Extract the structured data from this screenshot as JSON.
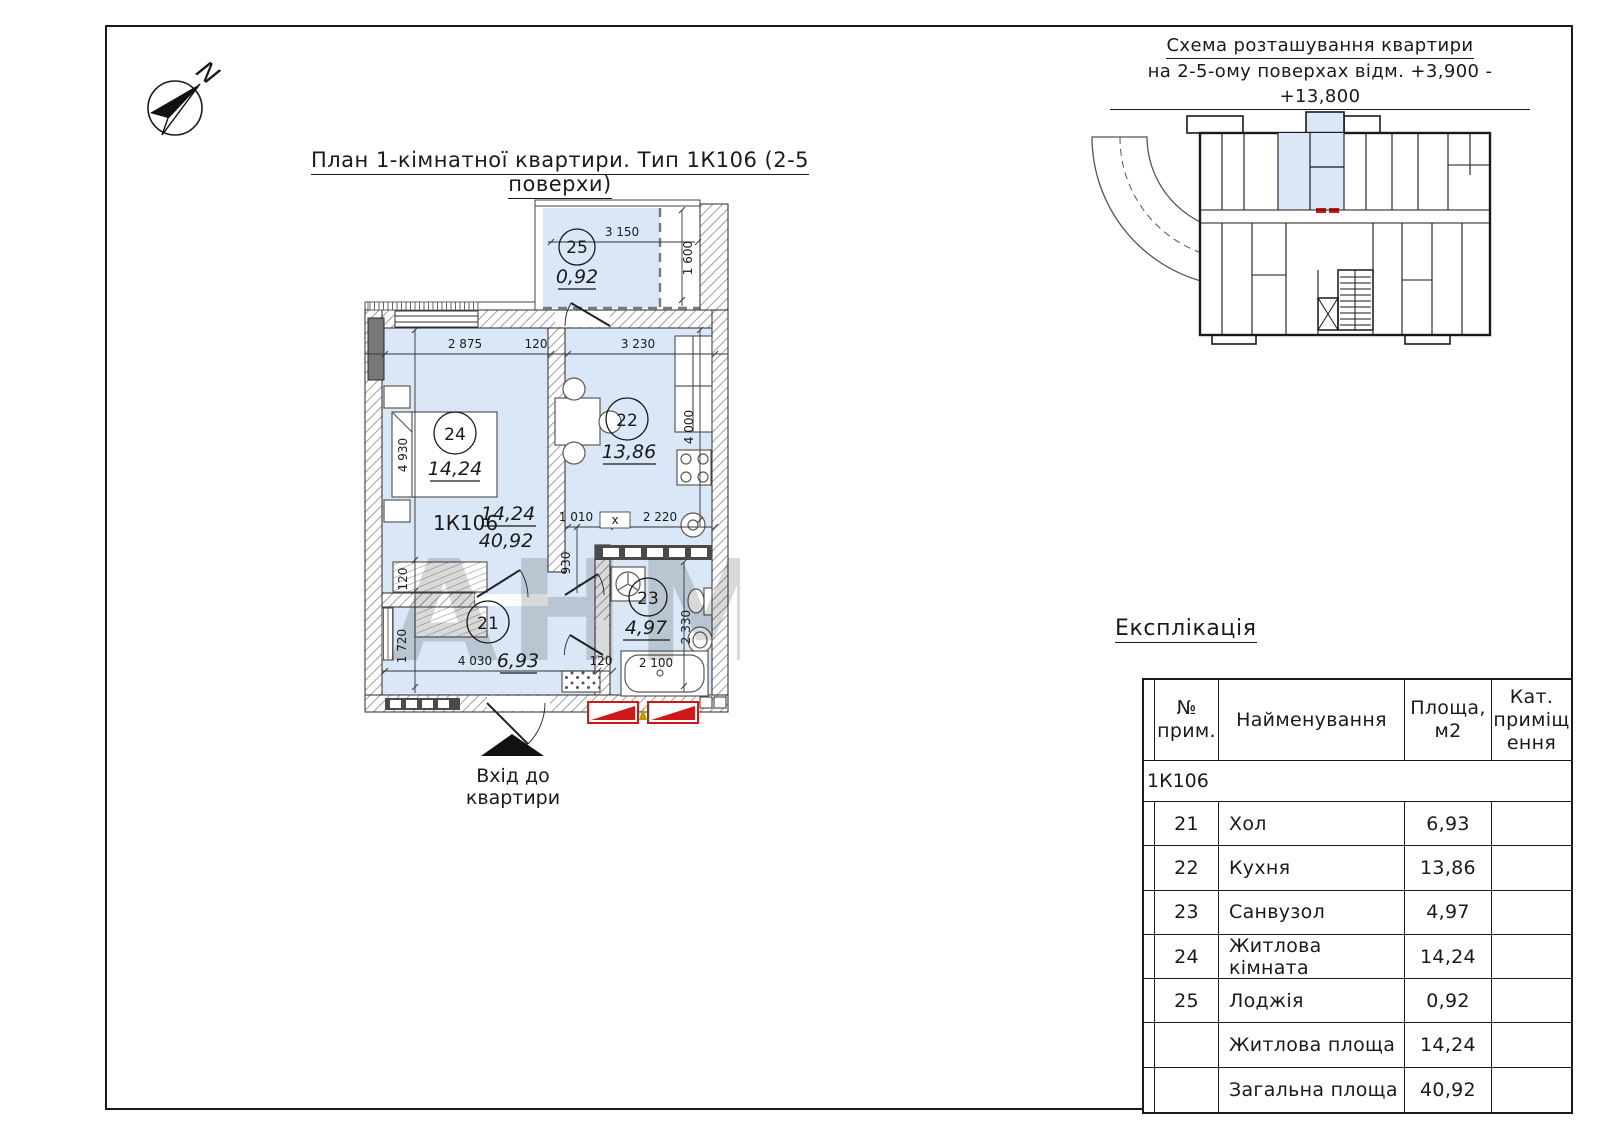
{
  "colors": {
    "room_fill": "#d9e7f6",
    "accent_red": "#d01818",
    "line": "#1a1a1a"
  },
  "compass": {
    "north_label": "N"
  },
  "titles": {
    "plan": "План 1-кімнатної квартири. Тип 1К106 (2-5 поверхи)",
    "schema_line1": "Схема розташування квартири",
    "schema_line2": "на 2-5-ому поверхах відм. +3,900 - +13,800",
    "explication": "Експлікація"
  },
  "apartment": {
    "code": "1К106",
    "living_area": "14,24",
    "total_area": "40,92"
  },
  "entrance": {
    "line1": "Вхід до",
    "line2": "квартири"
  },
  "rooms": {
    "r21": {
      "number": "21",
      "area": "6,93"
    },
    "r22": {
      "number": "22",
      "area": "13,86"
    },
    "r23": {
      "number": "23",
      "area": "4,97"
    },
    "r24": {
      "number": "24",
      "area": "14,24"
    },
    "r25": {
      "number": "25",
      "area": "0,92"
    }
  },
  "dims": {
    "loggia_w": "3 150",
    "loggia_d": "1 600",
    "top_a": "2 875",
    "top_b": "120",
    "top_c": "3 230",
    "room24_d": "4 930",
    "room22_d": "4 000",
    "mid_a": "1 010",
    "mid_b": "2 220",
    "mid_x": "х",
    "corridor": "930",
    "hall_w": "4 030",
    "hall_t": "120",
    "left_a": "120",
    "left_b": "1 720",
    "bath_d": "2 330",
    "tub_l": "2 100"
  },
  "watermark": "АНМ",
  "explication": {
    "header": {
      "col_num": [
        "№",
        "прим."
      ],
      "col_name": [
        "Найменування"
      ],
      "col_area": [
        "Площа,",
        "м2"
      ],
      "col_cat": [
        "Кат.",
        "приміщ",
        "ення"
      ]
    },
    "group_label": "1К106",
    "rows": [
      {
        "num": "21",
        "name": "Хол",
        "area": "6,93",
        "cat": ""
      },
      {
        "num": "22",
        "name": "Кухня",
        "area": "13,86",
        "cat": ""
      },
      {
        "num": "23",
        "name": "Санвузол",
        "area": "4,97",
        "cat": ""
      },
      {
        "num": "24",
        "name": "Житлова кімната",
        "area": "14,24",
        "cat": ""
      },
      {
        "num": "25",
        "name": "Лоджія",
        "area": "0,92",
        "cat": ""
      },
      {
        "num": "",
        "name": "Житлова площа",
        "area": "14,24",
        "cat": ""
      },
      {
        "num": "",
        "name": "Загальна площа",
        "area": "40,92",
        "cat": ""
      }
    ]
  }
}
